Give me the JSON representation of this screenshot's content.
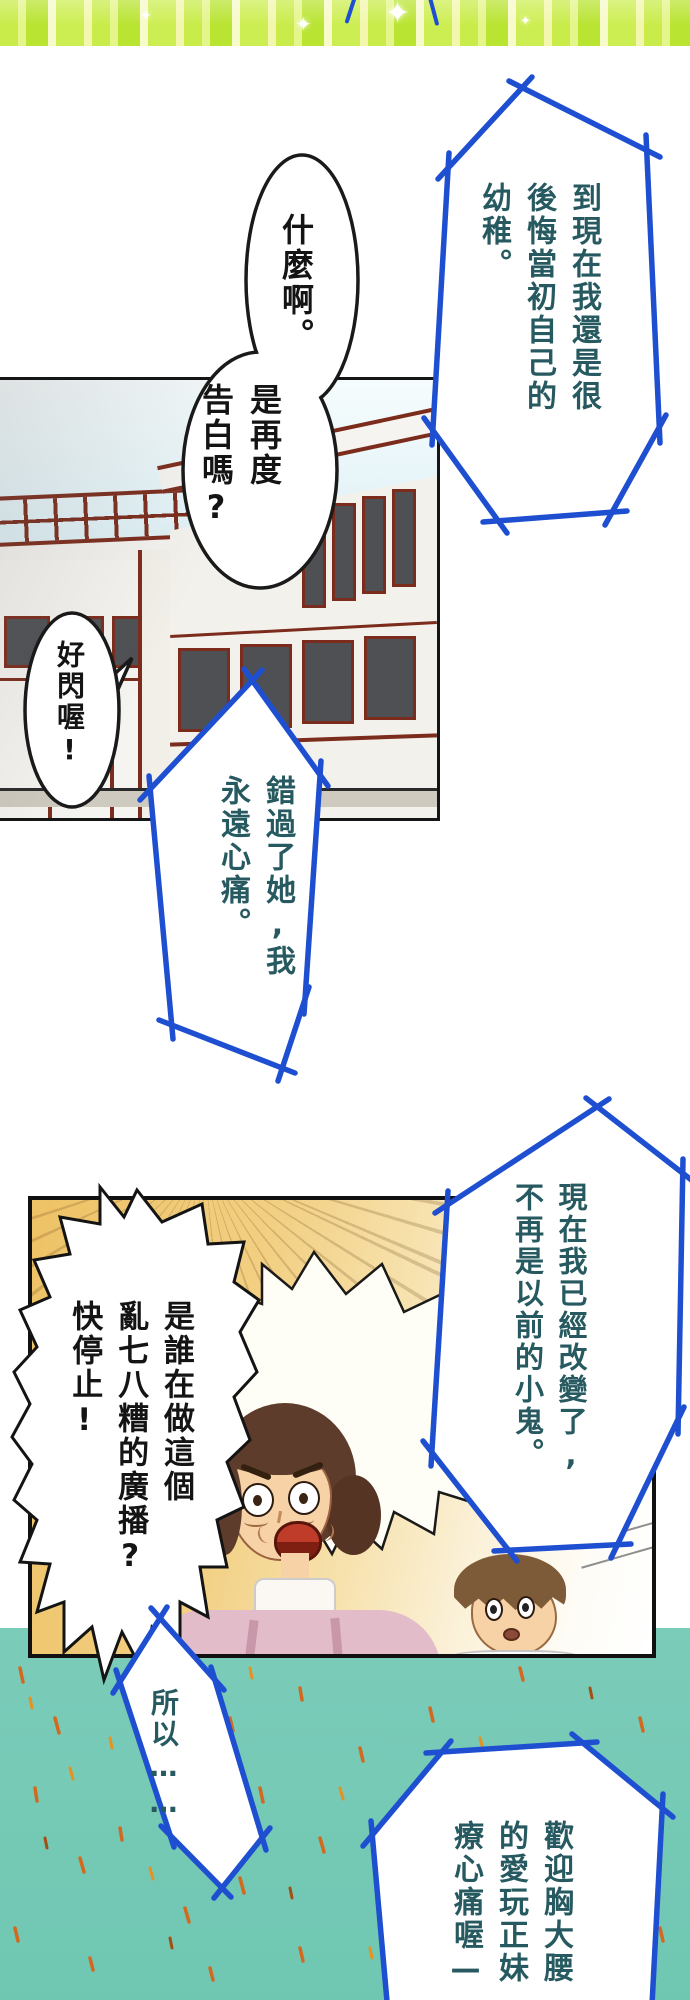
{
  "bubbles": {
    "regret": {
      "text": "到現在我還是很\n後悔當初自己的\n幼稚。"
    },
    "what_top": {
      "text": "什麼啊。"
    },
    "what_bottom": {
      "text": "是再度\n告白嗎?"
    },
    "dazzle": {
      "text": "好閃喔!"
    },
    "missed": {
      "text": "錯過了她,我\n永遠心痛。"
    },
    "changed": {
      "text": "現在我已經改變了,\n不再是以前的小鬼。"
    },
    "who_radio": {
      "text": "是誰在做這個\n亂七八糟的廣播?\n快停止!"
    },
    "so": {
      "text": "所以……"
    },
    "welcome": {
      "text": "歡迎胸大腰\n的愛玩正妹\n療心痛喔—"
    }
  },
  "banner": {
    "sparkle_glyph": "✦"
  },
  "colors": {
    "bubble_stroke": "#1e4fd1",
    "bubble_text_teal": "#275a60",
    "ink": "#141414",
    "building_line": "#7b2c1c",
    "teal_background": "#6fc7b2",
    "spark_orange": "#d2691e",
    "banner_green": "#c9ec4a",
    "panel_gold": "#eec266"
  }
}
